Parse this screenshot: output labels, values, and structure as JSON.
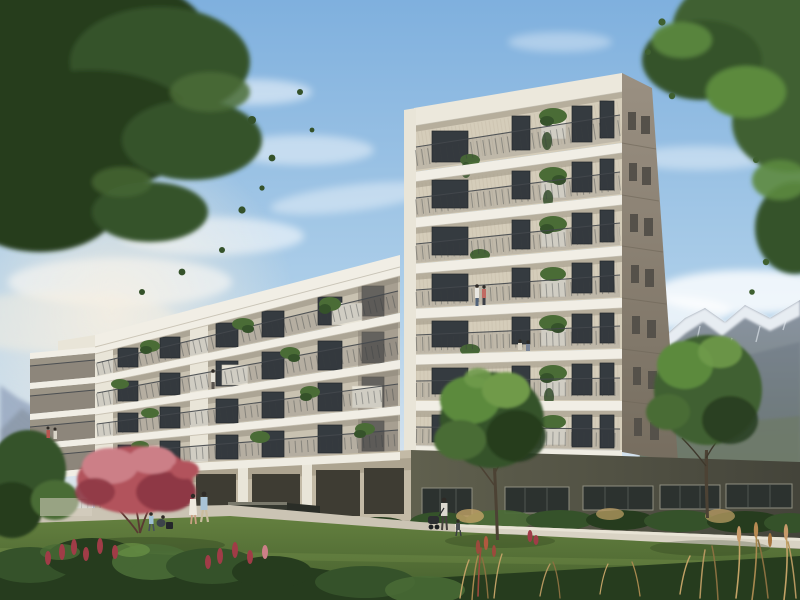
{
  "meta": {
    "description": "Sunlit architectural rendering of a modern residential complex: a seven-storey balcony tower joined to a four-storey wing above an olive-green commercial ground floor, framed by overhanging tree canopies, lawns, ornamental grasses, strolling residents and snow-capped alpine mountains under a blue sky with wispy clouds.",
    "image_type": "architectural-visualization",
    "visible_text": "none",
    "canvas": {
      "width": 800,
      "height": 600
    }
  },
  "palette": {
    "sky-top": "#7fb0de",
    "sky-mid": "#aecfe9",
    "sky-low": "#d6e3ee",
    "sky-horizon": "#ece8dc",
    "cloud": "#ffffff",
    "sun-haze": "#f6efe2",
    "mtn-main": "#8b95a5",
    "mtn-shadow": "#65707e",
    "mtn-foot": "#6e7a6b",
    "mtn-far": "#94a4bd",
    "snow": "#edf2f7",
    "facade": "#ece8dc",
    "slab": "#f1eee5",
    "slab-shade": "#b9b1a0",
    "recess-tower": "#d5cdba",
    "recess-wing": "#c9c2b1",
    "side-top": "#9a9082",
    "side-bottom": "#766d5f",
    "pier": "#e9e5d8",
    "glass": "#353b40",
    "frame": "#24282c",
    "glass-hi": "#7c8891",
    "rail": "#44484c",
    "plinth-left": "#c3baa6",
    "plinth-right": "#60604e",
    "plinth-dark": "#44443a",
    "storefront": "#2c322f",
    "mullion": "#8f8f80",
    "fascia": "#efece2",
    "path": "#cbc4b4",
    "low-wall": "#d9d3c4",
    "sign": "#34372f",
    "lawn": "#64803f",
    "lawn-dark": "#4b6531",
    "lawn-light": "#85a055",
    "tree-dark": "#263c1e",
    "tree-mid": "#35522a",
    "tree-light": "#4a6c36",
    "tree-bright": "#6f9a4a",
    "tree2-mid": "#3f6030",
    "tree2-light": "#5c8a3e",
    "maple": "#b2525c",
    "maple-light": "#cc7f87",
    "maple-dark": "#8e3744",
    "trunk": "#4c4234",
    "grass-tan": "#c2a266",
    "grass-brown": "#8a7040",
    "plume": "#9c4a3c",
    "flower-red": "#a03c47",
    "skin": "#c9a183",
    "hair": "#2e2a26"
  },
  "scene": {
    "sky": {
      "condition": "clear blue with wispy cirrus and soft cumulus",
      "light": "warm afternoon sun from the left"
    },
    "mountains": {
      "right": "snow-capped alpine range",
      "left": "faint blue foothill ridge"
    },
    "buildings": {
      "tower": {
        "floors": 7,
        "facade": "cream plaster with continuous balconies",
        "balustrade": "dark metal railings",
        "planters": "white boxes with trailing greenery",
        "shaded_side": "taupe side wall with small windows"
      },
      "wing": {
        "floors": 4,
        "facade": "white floor slabs with recessed grey balconies",
        "end_balconies": "stacked corner balconies at west end"
      },
      "ground_floor": {
        "finish": "olive-green plaster plinth",
        "glazing": "full-height storefront windows"
      }
    },
    "landscape": {
      "lawn": "sunlit green lawn",
      "path": "light concrete walkway",
      "low_wall": "cast concrete seating wall",
      "sign_wall": "dark stone monument wall",
      "trees": [
        "overhanging canopy top-left",
        "overhanging canopy top-right",
        "red japanese maple",
        "courtyard tree center",
        "courtyard tree right",
        "green tree far left"
      ],
      "planting": [
        "red flower spikes",
        "mixed shrubs",
        "golden ornamental grasses"
      ]
    },
    "people": [
      {
        "where": "lawn center-left",
        "who": "couple walking"
      },
      {
        "where": "lawn left",
        "who": "child and crouching adult"
      },
      {
        "where": "walkway right",
        "who": "woman pushing stroller with toddler"
      },
      {
        "where": "tower balcony upper floor",
        "who": "standing couple"
      },
      {
        "where": "tower balcony mid floor",
        "who": "two people seated"
      },
      {
        "where": "wing balcony",
        "who": "person at railing"
      },
      {
        "where": "west corner balcony",
        "who": "two residents"
      }
    ]
  }
}
